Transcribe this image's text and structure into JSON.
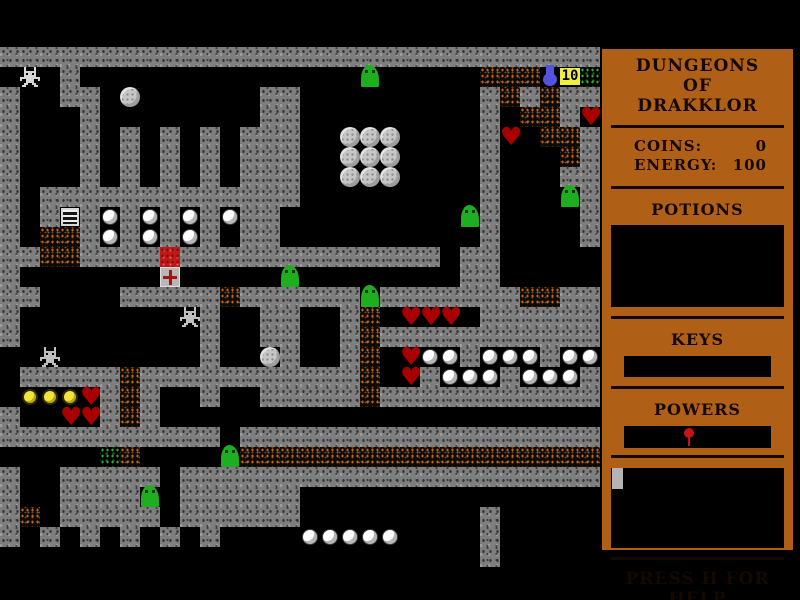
{
  "sidebar": {
    "title_lines": [
      "DUNGEONS",
      "OF",
      "DRAKKLOR"
    ],
    "stats": {
      "coins_label": "COINS:",
      "coins_value": "0",
      "energy_label": "ENERGY:",
      "energy_value": "100"
    },
    "potions": {
      "label": "POTIONS",
      "items": []
    },
    "keys": {
      "label": "KEYS",
      "items": []
    },
    "powers": {
      "label": "POWERS",
      "items": [
        "red-power-pin"
      ]
    },
    "message_box": {
      "cursor": "gray-block"
    },
    "help_text": "PRESS H FOR HELP",
    "colors": {
      "panel": "#b05f16",
      "text": "#140800",
      "box": "#000000"
    }
  },
  "map": {
    "cols": 30,
    "rows": 26,
    "tile_size": 20,
    "origin_y": 47,
    "badge_text": "10",
    "legend": {
      "#": "wall-tile",
      ".": "floor",
      "r": "rubble-tile",
      "g": "moss-tile",
      "o": "boulder",
      "w": "pearl",
      "y": "gold-orb",
      "h": "heart",
      "S": "slime-creature",
      "P": "player-sprite",
      "T": "statue-creature",
      "L": "grate",
      "C": "crate",
      "X": "medkit-crate",
      "F": "blue-flask",
      "B": "count-badge"
    },
    "grid": [
      "##############################",
      ".P.#..............S.....rrrFBg",
      "#..##.o......##.........#r#r##",
      "#...#........##.........#.rr#h",
      "#...#.#.#.#.###..ooo....#h.rr#",
      "#...#.#.#.#.###..ooo....#...r#",
      "#...#.#.#.#.###..ooo....#...##",
      "#.#############.........#...S#",
      "#.#L#w#w#w#w##.........S#....#",
      "#.rr#w#w#w#.##..........#....#",
      "##rr####C#############.##.....",
      "#.......X.....S........##.....",
      "##....#####r######S#######rr##",
      "#........T#..##..#r.hhh.######",
      "#.........#..##..#r###########",
      "..T.......#..o#..#r.hww#www#ww",
      ".#####r###########r.h#www#www#",
      ".yyyh#r#..#..#####r###########",
      "#..hh#r#......................",
      "###########.##################",
      ".....gr....Srrrrrrrrrrrrrrrrrr",
      "#..#####.#####################",
      "#..####S.######...............",
      "#r.#####.######.........#.....",
      "#.#.#.#.#.#....wwwww....#.....",
      "........................#....."
    ],
    "colors": {
      "wall": "#7e7e7e",
      "rubble": "#bd631c",
      "moss": "#2fae2f",
      "slime": "#1fae1f",
      "heart": "#a80000",
      "gold": "#f2e43c",
      "flask": "#5353dd",
      "badge_bg": "#f2ee3f"
    }
  }
}
